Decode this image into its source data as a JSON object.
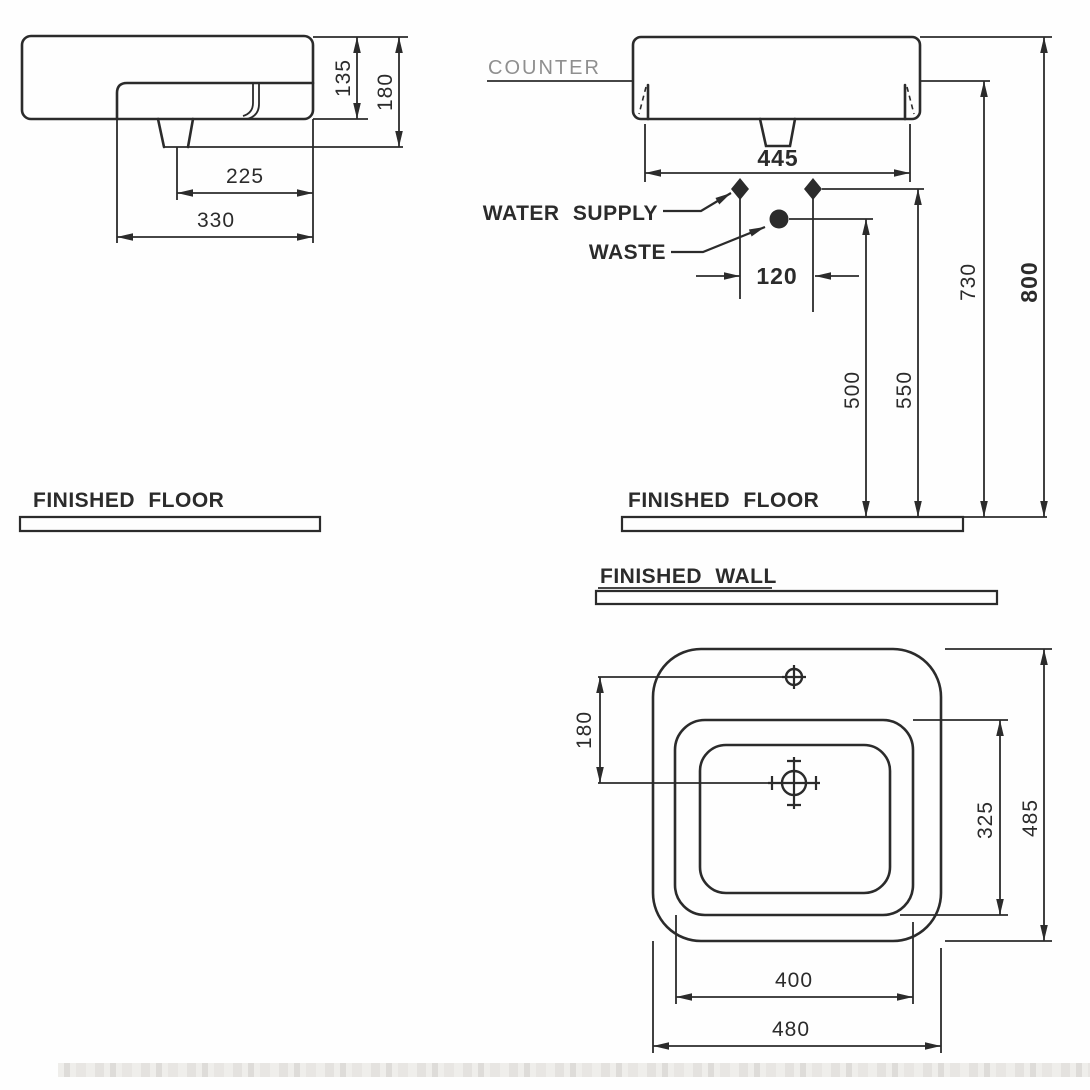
{
  "drawing": {
    "side_view": {
      "dims": {
        "d135": "135",
        "d180": "180",
        "d225": "225",
        "d330": "330"
      }
    },
    "front_view": {
      "labels": {
        "counter": "COUNTER",
        "water_supply": "WATER SUPPLY",
        "waste": "WASTE"
      },
      "dims": {
        "d445": "445",
        "d120": "120",
        "d500": "500",
        "d550": "550",
        "d730": "730",
        "d800": "800"
      }
    },
    "levels": {
      "finished_floor_left": "FINISHED FLOOR",
      "finished_floor_right": "FINISHED FLOOR",
      "finished_wall": "FINISHED WALL"
    },
    "plan_view": {
      "dims": {
        "d180": "180",
        "d325": "325",
        "d485": "485",
        "d400": "400",
        "d480": "480"
      }
    }
  },
  "colors": {
    "line": "#2b2b2b",
    "counter_label": "#8f8f8f",
    "background": "#fefefe",
    "photo_edge_strip": "#e8e6e2"
  }
}
